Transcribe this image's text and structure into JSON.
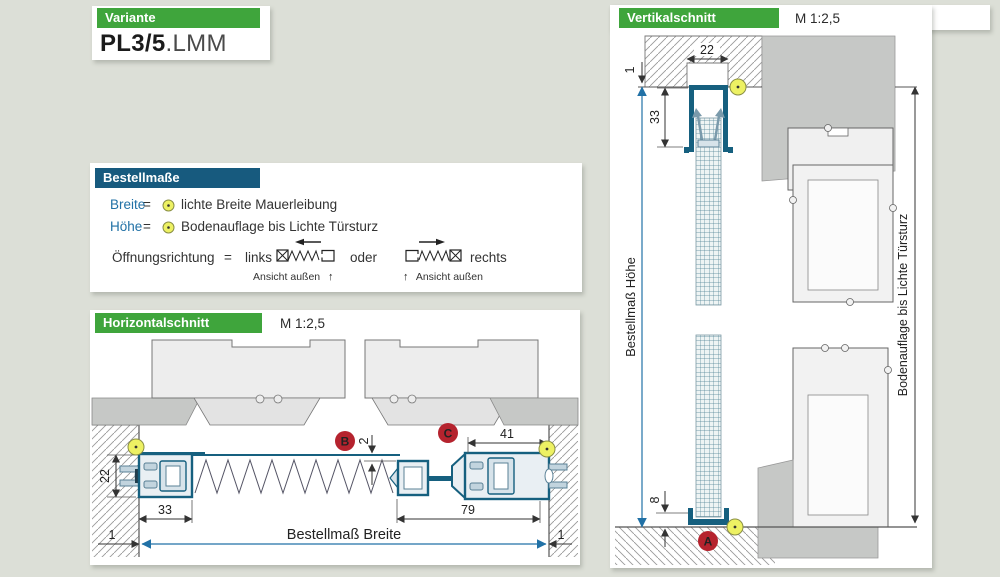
{
  "colors": {
    "background": "#dcdfd7",
    "panel": "#ffffff",
    "header_green": "#3fa53c",
    "header_blue": "#175a7e",
    "accent_blue_text": "#2171a6",
    "profile_blue": "#16607f",
    "marker_red": "#b5232e",
    "marker_yellow": "#edf163",
    "profile_gray_dark": "#c6c8c6",
    "profile_gray_light": "#efefef"
  },
  "variante": {
    "header": "Variante",
    "code_bold": "PL3/5",
    "code_suffix": ".LMM"
  },
  "bestellmasse": {
    "header": "Bestellmaße",
    "rows": [
      {
        "term": "Breite",
        "eq": "=",
        "desc": "lichte Breite Mauerleibung"
      },
      {
        "term": "Höhe",
        "eq": "=",
        "desc": "Bodenauflage bis Lichte Türsturz"
      }
    ],
    "opening": {
      "label": "Öffnungsrichtung",
      "eq": "=",
      "left": "links",
      "or": "oder",
      "right": "rechts",
      "view": "Ansicht außen",
      "arrow_up": "↑"
    }
  },
  "horizontal": {
    "header": "Horizontalschnitt",
    "scale": "M 1:2,5",
    "breite_label": "Bestellmaß Breite",
    "dims": {
      "d22": "22",
      "d33": "33",
      "d79": "79",
      "d41": "41",
      "d2": "2",
      "d1l": "1",
      "d1r": "1"
    },
    "markers": {
      "b": "B",
      "c": "C"
    }
  },
  "vertikal": {
    "header": "Vertikalschnitt",
    "scale": "M 1:2,5",
    "hoehe_label": "Bestellmaß Höhe",
    "sturz_label": "Bodenauflage bis Lichte Türsturz",
    "dims": {
      "d22": "22",
      "d1": "1",
      "d33": "33",
      "d8": "8"
    },
    "markers": {
      "a": "A"
    }
  }
}
